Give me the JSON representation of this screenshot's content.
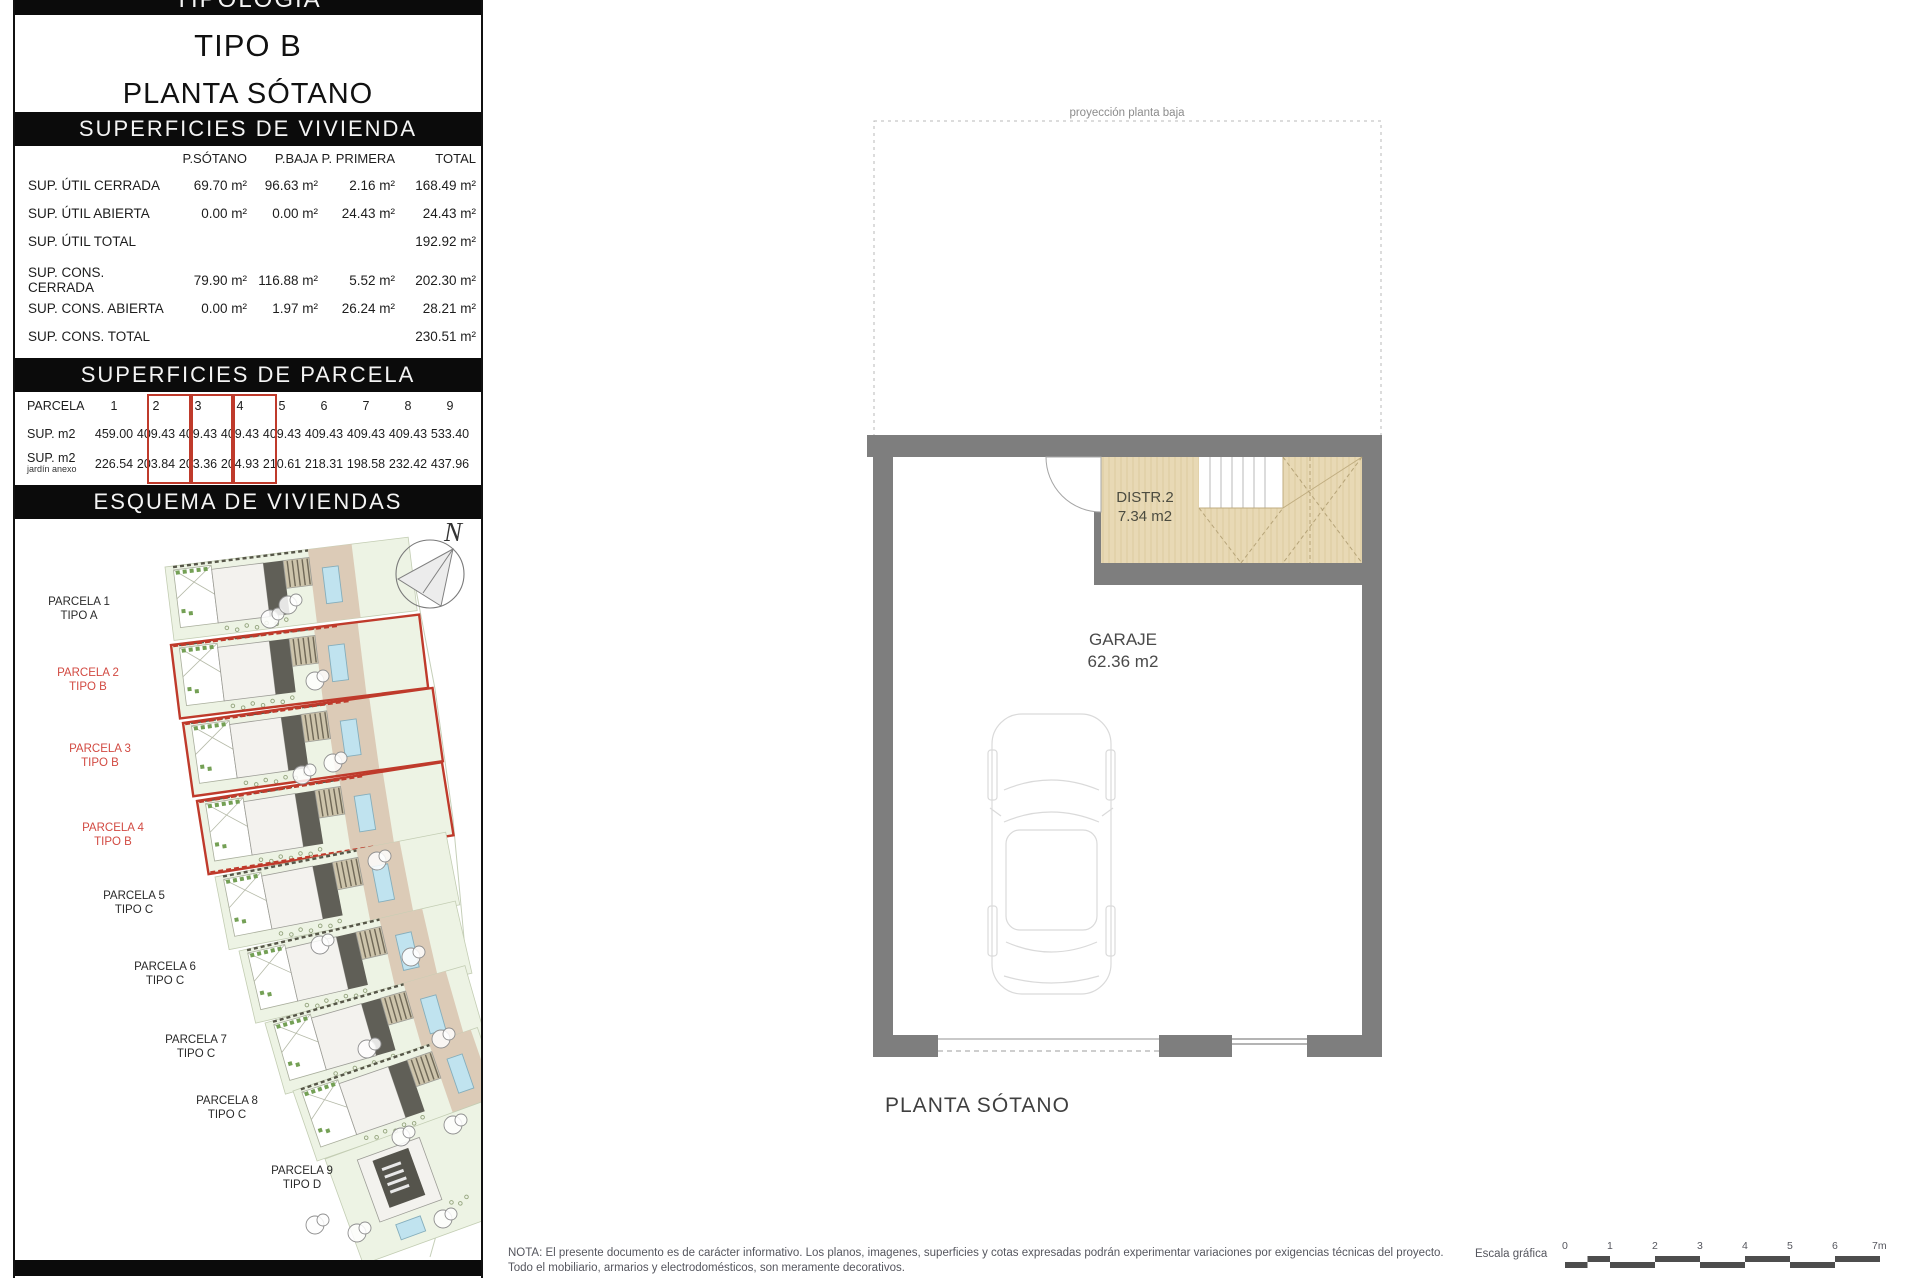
{
  "panel": {
    "top_bar": "TIPOLOGÍA",
    "title_line1": "TIPO B",
    "title_line2": "PLANTA SÓTANO",
    "vivienda": {
      "header": "SUPERFICIES DE VIVIENDA",
      "columns": [
        "P.SÓTANO",
        "P.BAJA",
        "P. PRIMERA",
        "TOTAL"
      ],
      "rows": [
        {
          "label": "SUP. ÚTIL CERRADA",
          "values": [
            "69.70 m²",
            "96.63 m²",
            "2.16 m²",
            "168.49 m²"
          ]
        },
        {
          "label": "SUP. ÚTIL ABIERTA",
          "values": [
            "0.00 m²",
            "0.00 m²",
            "24.43 m²",
            "24.43 m²"
          ]
        },
        {
          "label": "SUP. ÚTIL TOTAL",
          "values": [
            "",
            "",
            "",
            "192.92 m²"
          ]
        },
        {
          "label": "SUP. CONS.  CERRADA",
          "values": [
            "79.90 m²",
            "116.88 m²",
            "5.52 m²",
            "202.30 m²"
          ]
        },
        {
          "label": "SUP. CONS.  ABIERTA",
          "values": [
            "0.00 m²",
            "1.97 m²",
            "26.24 m²",
            "28.21 m²"
          ]
        },
        {
          "label": "SUP. CONS.  TOTAL",
          "values": [
            "",
            "",
            "",
            "230.51 m²"
          ]
        }
      ]
    },
    "parcela": {
      "header": "SUPERFICIES DE PARCELA",
      "row_label": "PARCELA",
      "sup_label": "SUP. m2",
      "jardin_label": "SUP. m2",
      "jardin_sublabel": "jardín anexo",
      "numbers": [
        "1",
        "2",
        "3",
        "4",
        "5",
        "6",
        "7",
        "8",
        "9"
      ],
      "sup": [
        "459.00",
        "409.43",
        "409.43",
        "409.43",
        "409.43",
        "409.43",
        "409.43",
        "409.43",
        "533.40"
      ],
      "jardin": [
        "226.54",
        "203.84",
        "203.36",
        "204.93",
        "210.61",
        "218.31",
        "198.58",
        "232.42",
        "437.96"
      ],
      "highlighted_parcels": [
        "2",
        "3",
        "4"
      ]
    },
    "esquema": {
      "header": "ESQUEMA DE VIVIENDAS",
      "compass": "N",
      "labels": [
        {
          "name": "PARCELA 1",
          "tipo": "TIPO A"
        },
        {
          "name": "PARCELA 2",
          "tipo": "TIPO B"
        },
        {
          "name": "PARCELA 3",
          "tipo": "TIPO B"
        },
        {
          "name": "PARCELA 4",
          "tipo": "TIPO B"
        },
        {
          "name": "PARCELA 5",
          "tipo": "TIPO C"
        },
        {
          "name": "PARCELA 6",
          "tipo": "TIPO C"
        },
        {
          "name": "PARCELA 7",
          "tipo": "TIPO C"
        },
        {
          "name": "PARCELA 8",
          "tipo": "TIPO C"
        },
        {
          "name": "PARCELA 9",
          "tipo": "TIPO D"
        }
      ]
    }
  },
  "plan": {
    "projection_label": "proyección planta baja",
    "distr_name": "DISTR.2",
    "distr_area": "7.34 m2",
    "garage_name": "GARAJE",
    "garage_area": "62.36 m2",
    "caption": "PLANTA SÓTANO"
  },
  "footer": {
    "note_line1": "NOTA: El presente documento es de carácter informativo. Los planos, imagenes, superficies y cotas expresadas podrán experimentar variaciones por exigencias técnicas del proyecto.",
    "note_line2": "Todo el mobiliario, armarios y electrodomésticos, son meramente decorativos.",
    "scale_label": "Escala gráfica",
    "scale_ticks": [
      "0",
      "1",
      "2",
      "3",
      "4",
      "5",
      "6",
      "7m"
    ]
  },
  "colors": {
    "bar_black": "#0b0b0b",
    "highlight_red": "#bf3a2b",
    "wall_gray": "#7e7e7e",
    "stair_tan": "#e8d9b5",
    "parcel_green": "#edf3e4",
    "pool_blue": "#c0e3ef",
    "driveway_tan": "#dccbb7"
  }
}
